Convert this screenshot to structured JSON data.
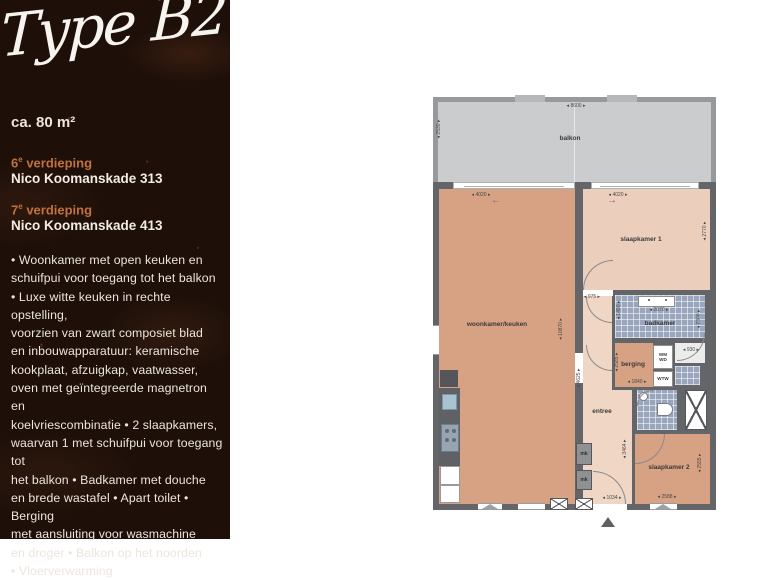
{
  "panel": {
    "type_title": "Type B2",
    "area": "ca. 80 m²",
    "accent_color": "#c1713d",
    "background_color": "#1e1009",
    "floors": [
      {
        "num": "6",
        "sup": "e",
        "word": "verdieping",
        "address": "Nico Koomanskade 313"
      },
      {
        "num": "7",
        "sup": "e",
        "word": "verdieping",
        "address": "Nico Koomanskade 413"
      }
    ],
    "description": "• Woonkamer met open keuken en\nschuifpui voor toegang tot het balkon\n• Luxe witte keuken in rechte opstelling,\nvoorzien van zwart composiet blad\nen inbouwapparatuur: keramische\nkookplaat, afzuigkap, vaatwasser,\noven met geïntegreerde magnetron en\nkoelvriescombinatie • 2 slaapkamers,\nwaarvan 1 met schuifpui voor toegang tot\nhet balkon • Badkamer met douche\nen brede wastafel • Apart toilet • Berging\nmet aansluiting voor wasmachine\nen droger • Balkon op het noorden\n• Vloerverwarming"
  },
  "plan": {
    "labels": {
      "balkon": "balkon",
      "woonkamer": "woonkamer/keuken",
      "slaapkamer1": "slaapkamer 1",
      "slaapkamer2": "slaapkamer 2",
      "badkamer": "badkamer",
      "berging": "berging",
      "entree": "entree",
      "mk1": "mk",
      "mk2": "mk",
      "wm": "WM",
      "wd": "WD",
      "wtw": "WTW"
    },
    "dims": {
      "balkon_width": "8600",
      "balkon_depth": "2530",
      "woonkamer_door": "4020",
      "slaapkamer1_door": "4020",
      "slaapkamer1_depth": "2770",
      "woonkamer_length": "10870",
      "hal_door": "975",
      "hal_length": "4625",
      "badkamer_width": "2070",
      "badkamer_depth": "1490",
      "badkamer_right": "2300",
      "toilet_width": "930",
      "berging_depth": "2585",
      "berging_width": "1840",
      "entree_length": "3464",
      "entree_door": "1034",
      "slaapkamer2_depth": "2555",
      "slaapkamer2_width": "2588"
    },
    "arrows": {
      "left": "←",
      "right": "→"
    },
    "colors": {
      "wall": "#636568",
      "living": "#d7a183",
      "bedroom": "#ebcfbc",
      "hall": "#efd6c5",
      "balcony": "#caccce",
      "tile": "#9aa6bd"
    }
  }
}
